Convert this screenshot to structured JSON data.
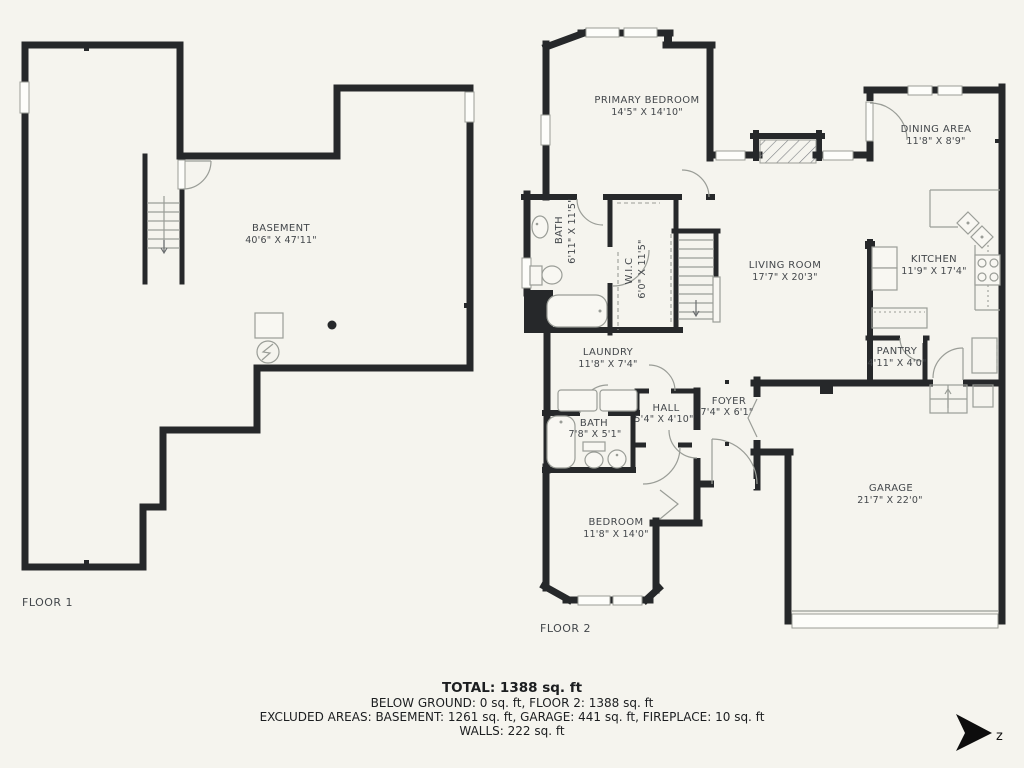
{
  "theme": {
    "background": "#f5f4ee",
    "wall_color": "#26282a",
    "label_color": "#43474b",
    "fixture_line_color": "#9a9d97",
    "footer_text_color": "#1c1e20"
  },
  "floor1": {
    "label": "FLOOR 1",
    "rooms": [
      {
        "name": "BASEMENT",
        "dims": "40'6\" X 47'11\""
      }
    ]
  },
  "floor2": {
    "label": "FLOOR 2",
    "rooms": [
      {
        "name": "PRIMARY BEDROOM",
        "dims": "14'5\" X 14'10\""
      },
      {
        "name": "BATH",
        "dims": "6'11\" X 11'5\""
      },
      {
        "name": "W.I.C",
        "dims": "6'0\" X 11'5\""
      },
      {
        "name": "DINING AREA",
        "dims": "11'8\" X 8'9\""
      },
      {
        "name": "LIVING ROOM",
        "dims": "17'7\" X 20'3\""
      },
      {
        "name": "KITCHEN",
        "dims": "11'9\" X 17'4\""
      },
      {
        "name": "PANTRY",
        "dims": "4'11\" X 4'0\""
      },
      {
        "name": "LAUNDRY",
        "dims": "11'8\" X 7'4\""
      },
      {
        "name": "HALL",
        "dims": "5'4\" X 4'10\""
      },
      {
        "name": "FOYER",
        "dims": "7'4\" X 6'1\""
      },
      {
        "name": "BATH",
        "dims": "7'8\" X 5'1\""
      },
      {
        "name": "BEDROOM",
        "dims": "11'8\" X 14'0\""
      },
      {
        "name": "GARAGE",
        "dims": "21'7\" X 22'0\""
      }
    ]
  },
  "footer": {
    "total": "TOTAL: 1388 sq. ft",
    "line2": "BELOW GROUND: 0 sq. ft, FLOOR 2: 1388 sq. ft",
    "line3": "EXCLUDED AREAS: BASEMENT: 1261 sq. ft, GARAGE: 441 sq. ft, FIREPLACE: 10 sq. ft",
    "line4": "WALLS: 222 sq. ft"
  },
  "compass": {
    "letter": "z"
  }
}
